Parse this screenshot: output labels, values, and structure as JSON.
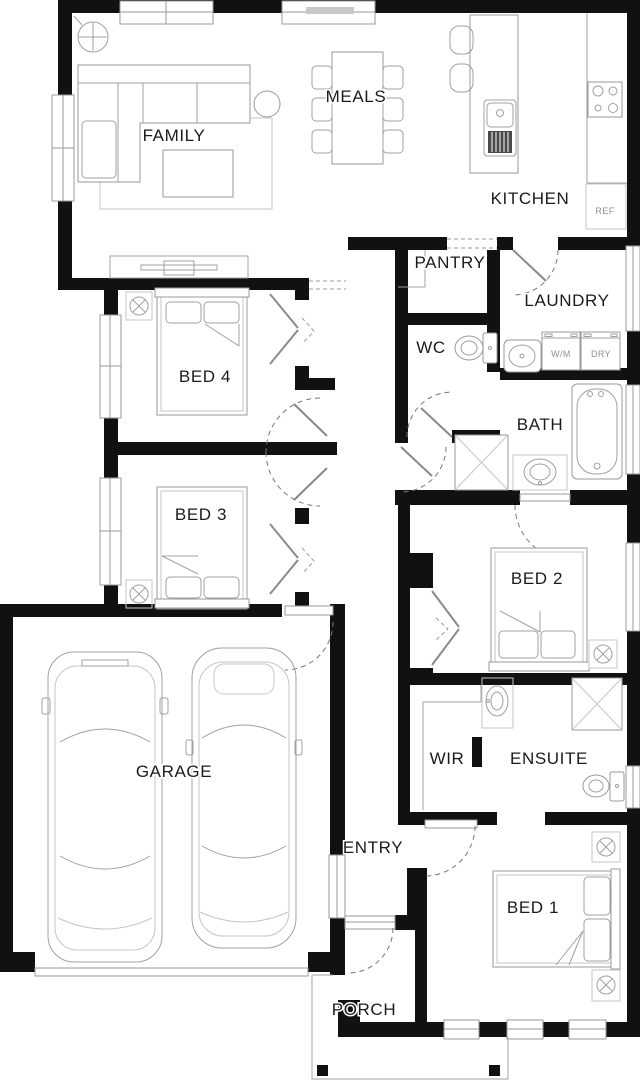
{
  "rooms": {
    "family": "FAMILY",
    "meals": "MEALS",
    "kitchen": "KITCHEN",
    "pantry": "PANTRY",
    "laundry": "LAUNDRY",
    "wc": "WC",
    "bed4": "BED 4",
    "bath": "BATH",
    "bed3": "BED 3",
    "bed2": "BED 2",
    "garage": "GARAGE",
    "wir": "WIR",
    "ensuite": "ENSUITE",
    "entry": "ENTRY",
    "bed1": "BED 1",
    "porch": "PORCH"
  },
  "appliances": {
    "ref": "REF",
    "washing_machine": "W/M",
    "dryer": "DRY"
  },
  "colors": {
    "wall": "#111111",
    "furniture_line": "#a0a0a0",
    "text": "#1b1b1b",
    "door_arc": "#777777",
    "background": "#ffffff"
  }
}
